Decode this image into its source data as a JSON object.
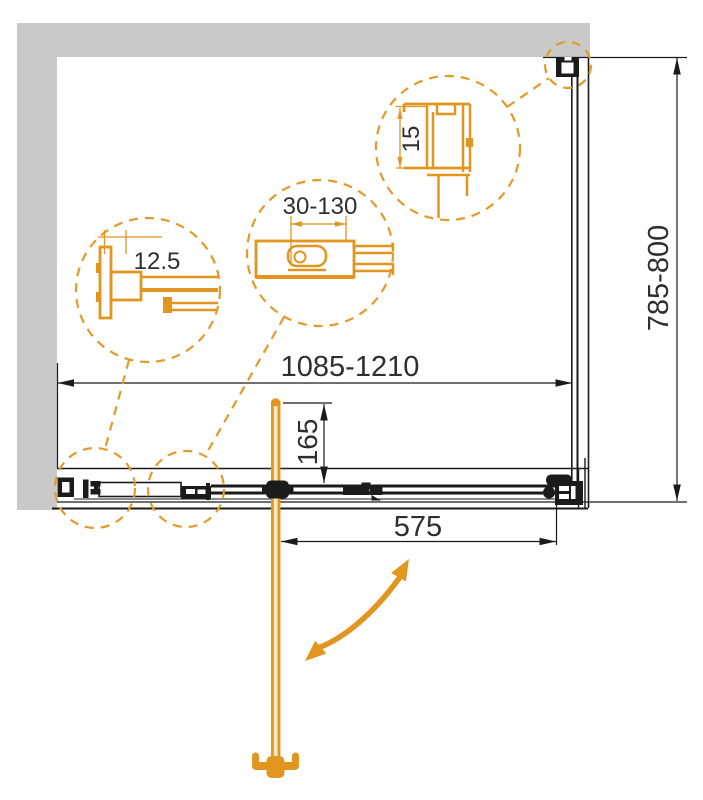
{
  "drawing": {
    "dimensions": {
      "width_range": "1085-1210",
      "depth_range": "785-800",
      "door_width": "575",
      "handle_offset": "165"
    },
    "details": {
      "left_circle": "12.5",
      "middle_circle": "30-130",
      "right_circle": "15"
    },
    "colors": {
      "accent": "#E2951F",
      "accent_light": "#F8E7C4",
      "wall_gray": "#C9C9C9",
      "line": "#1B1B1B",
      "text": "#2E2E2E"
    }
  }
}
